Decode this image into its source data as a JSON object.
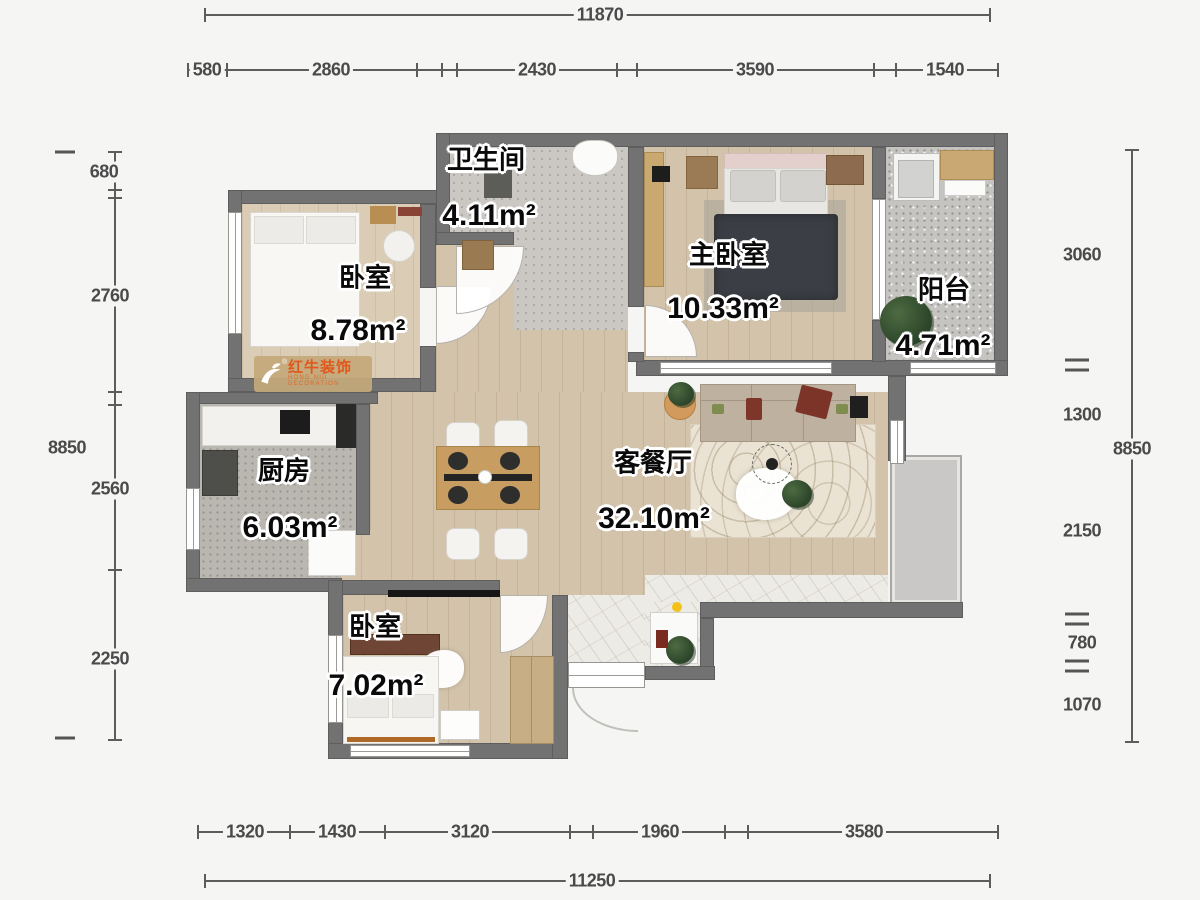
{
  "dimensions": {
    "top_total": "11870",
    "top_row": [
      "580",
      "2860",
      "2430",
      "3590",
      "1540"
    ],
    "left_inner": [
      "680",
      "2760",
      "2560",
      "2250"
    ],
    "left_total": "8850",
    "right_inner": [
      "3060",
      "1300",
      "2150",
      "780",
      "1070"
    ],
    "right_total": "8850",
    "bottom_row": [
      "1320",
      "1430",
      "3120",
      "1960",
      "3580"
    ],
    "bottom_total": "11250"
  },
  "rooms": [
    {
      "name": "卫生间",
      "area": "4.11m²"
    },
    {
      "name": "卧室",
      "area": "8.78m²"
    },
    {
      "name": "主卧室",
      "area": "10.33m²"
    },
    {
      "name": "阳台",
      "area": "4.71m²"
    },
    {
      "name": "厨房",
      "area": "6.03m²"
    },
    {
      "name": "客餐厅",
      "area": "32.10m²"
    },
    {
      "name": "卧室",
      "area": "7.02m²"
    }
  ],
  "watermark": {
    "brand": "红牛装饰",
    "sub": "HONG NIU DECORATION",
    "reg": "®"
  },
  "colors": {
    "wall": "#727272",
    "wood": "#d2c3aa",
    "tile": "#cbc8c3",
    "accent": "#e0581c",
    "dim_text": "#4a4a4a"
  }
}
